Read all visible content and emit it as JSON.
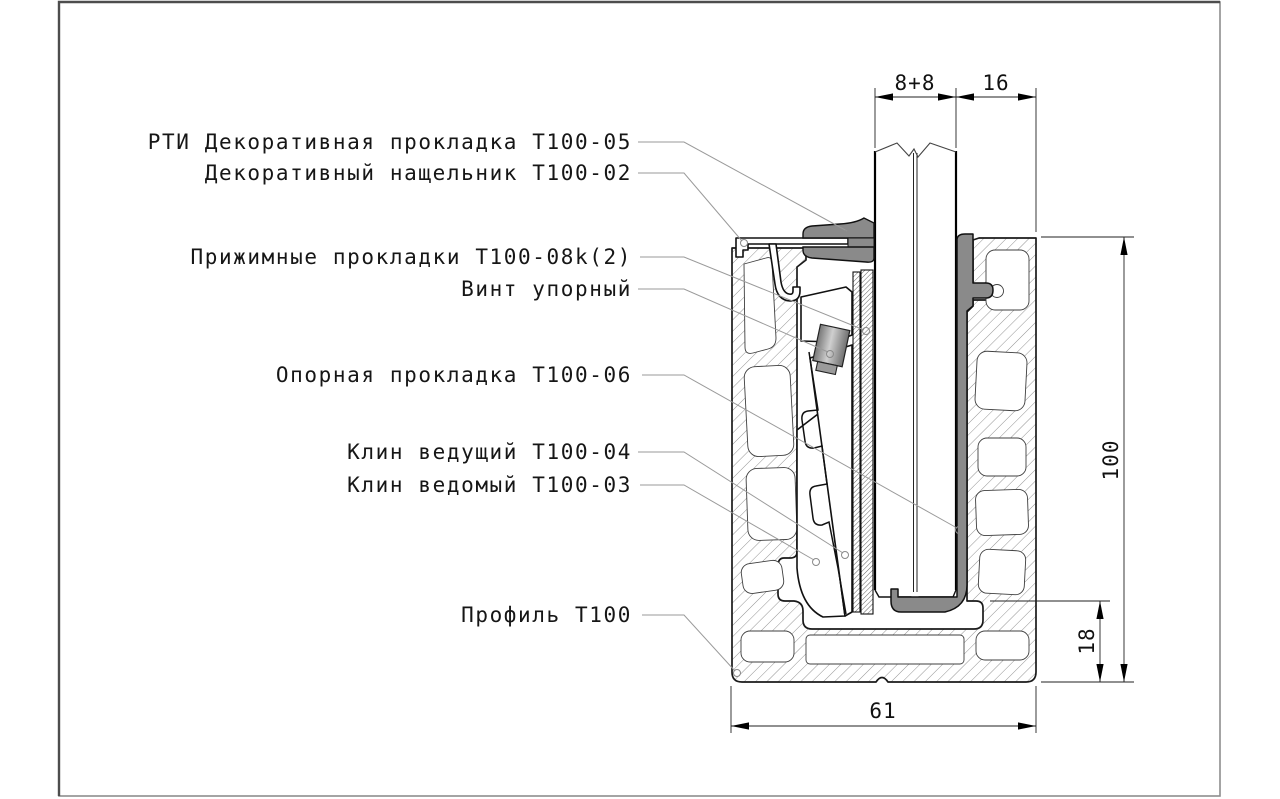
{
  "drawing": {
    "type": "technical-cross-section",
    "title_parts": "Узел крепления стекла в профиле Т100",
    "part_labels": [
      {
        "text": "РТИ Декоративная прокладка Т100-05"
      },
      {
        "text": "Декоративный нащельник Т100-02"
      },
      {
        "text": "Прижимные прокладки Т100-08k(2)"
      },
      {
        "text": "Винт упорный"
      },
      {
        "text": "Опорная прокладка Т100-06"
      },
      {
        "text": "Клин ведущий Т100-04"
      },
      {
        "text": "Клин ведомый Т100-03"
      },
      {
        "text": "Профиль Т100"
      }
    ],
    "dimensions": {
      "glass_package": "8+8",
      "side_gap": "16",
      "profile_height": "100",
      "bottom_flange": "18",
      "profile_width": "61"
    },
    "colors": {
      "rubber_gasket_fill": "#8a8a8a",
      "outline": "#1a1a1a",
      "leader_line": "#9a9a9a",
      "dimension_line": "#222222",
      "page_frame": "#6f6f6f"
    }
  }
}
